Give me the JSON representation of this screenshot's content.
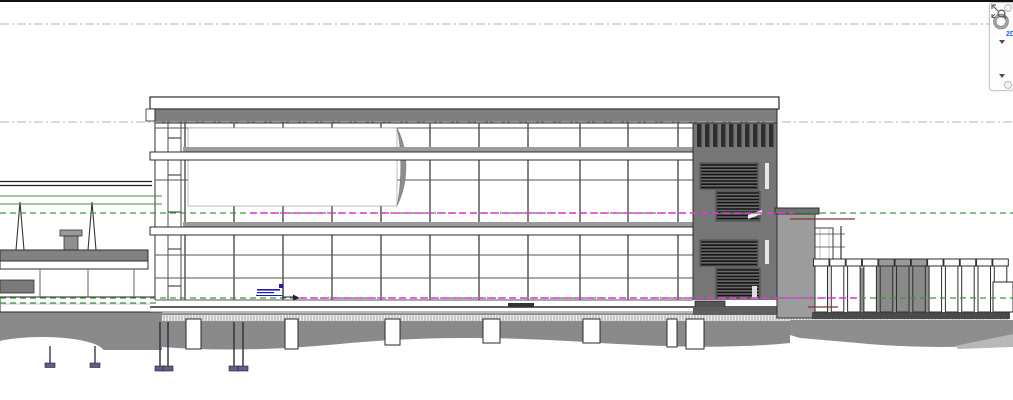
{
  "navigation_bar": {
    "wheel_label": "2D",
    "wheel_tool": "steering-wheel-2d",
    "zoom_tool": "zoom-region"
  },
  "colors": {
    "level_dashdot": "#b3b3b3",
    "level_green": "#3f9440",
    "level_magenta": "#ee33e0",
    "maroon": "#7d3434",
    "annotation_blue": "#1d1dbb",
    "annotation_dark": "#20233a",
    "parapet": "#7f7f7f",
    "band_shadow": "#9b9b9b",
    "tower_fill": "#767676",
    "tower_dark": "#2e2e2e",
    "stair_fill": "#6a6a6a",
    "terrain": "#8a8a8a",
    "terrain_light": "#b8b8b8",
    "deck": "#828282",
    "line_dark": "#2a2a2a",
    "line_mid": "#555555",
    "wheel_gray": "#8f8f8f",
    "wheel_blue": "#1464f0"
  },
  "drawing": {
    "levels": [
      {
        "y": 24,
        "style": "dashdot",
        "x1": 0,
        "x2": 1013
      },
      {
        "y": 122,
        "style": "dashdot",
        "x1": 0,
        "x2": 1013
      },
      {
        "y": 196,
        "style": "green_solid",
        "x1": 0,
        "x2": 162
      },
      {
        "y": 204,
        "style": "green_solid",
        "x1": 0,
        "x2": 162
      },
      {
        "y": 213,
        "style": "green_dash",
        "x1": 0,
        "x2": 1013
      },
      {
        "y": 213,
        "style": "magenta",
        "x1": 250,
        "x2": 793
      },
      {
        "y": 298,
        "style": "green_dash",
        "x1": 0,
        "x2": 1013
      },
      {
        "y": 298,
        "style": "magenta",
        "x1": 300,
        "x2": 860
      },
      {
        "y": 303,
        "style": "green_dash",
        "x1": 0,
        "x2": 160
      }
    ],
    "maroon_lines": [
      {
        "y": 219,
        "x1": 790,
        "x2": 855
      },
      {
        "y": 307,
        "x1": 808,
        "x2": 838
      }
    ],
    "building": {
      "facade_x1": 155,
      "facade_x2": 693,
      "top": 123,
      "base": 307,
      "mullions": [
        185,
        234,
        283,
        332,
        381,
        430,
        479,
        528,
        580,
        628,
        678
      ],
      "ladder_x": [
        168,
        181
      ],
      "ladder_rungs": [
        138,
        175,
        212,
        249,
        286
      ],
      "floor_lines": [
        128,
        180,
        255,
        278,
        300
      ],
      "bands_y": [
        152,
        227
      ],
      "tower": {
        "x1": 693,
        "x2": 777
      },
      "stair_blocks": [
        [
          700,
          163,
          58,
          26
        ],
        [
          716,
          191,
          44,
          30
        ],
        [
          700,
          240,
          58,
          26
        ],
        [
          716,
          268,
          44,
          30
        ]
      ]
    },
    "piers": [
      [
        186,
        15,
        30
      ],
      [
        285,
        13,
        30
      ],
      [
        385,
        15,
        26
      ],
      [
        483,
        17,
        24
      ],
      [
        583,
        17,
        24
      ],
      [
        667,
        10,
        28
      ],
      [
        686,
        18,
        30
      ]
    ],
    "pile_x": [
      160,
      168,
      234,
      243
    ],
    "walkway_pile_x": [
      50,
      95
    ],
    "mast_x": [
      20,
      92
    ],
    "colonnade": {
      "x_start": 815,
      "count": 12,
      "spacing": 16.3,
      "dark": [
        4,
        5,
        6
      ],
      "cap_y": 259,
      "shaft_y": 266,
      "base_y": 312
    }
  }
}
